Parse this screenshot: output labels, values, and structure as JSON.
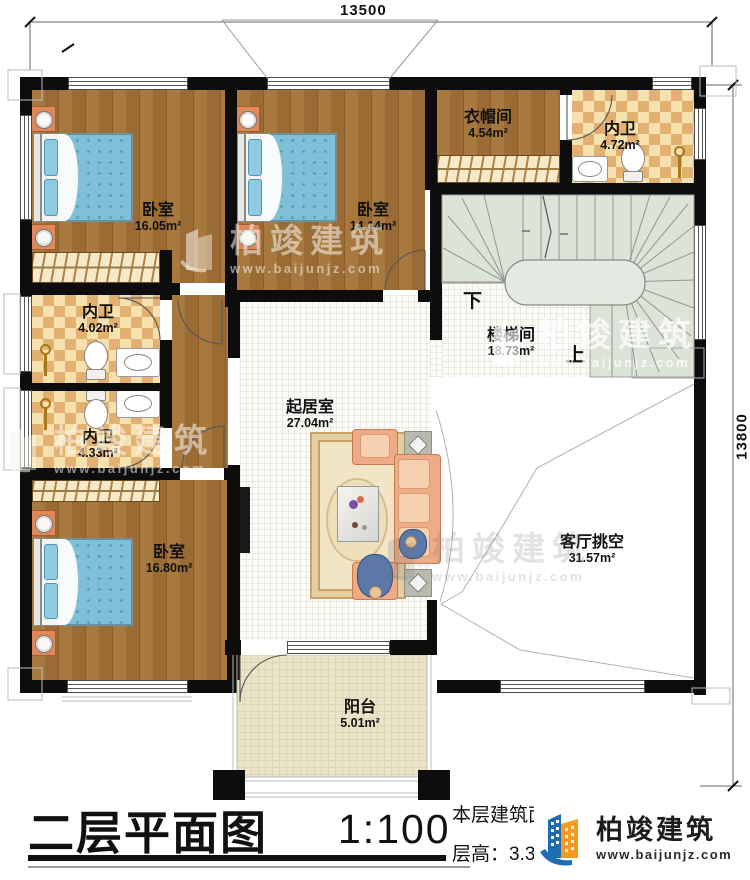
{
  "plan": {
    "dims": {
      "width": "13500",
      "height": "13800"
    },
    "stair_marks": {
      "down": "下",
      "up": "上"
    },
    "rooms": {
      "bedroom1": {
        "name": "卧室",
        "area": "16.05m²"
      },
      "bedroom2": {
        "name": "卧室",
        "area": "14.14m²"
      },
      "cloakroom": {
        "name": "衣帽间",
        "area": "4.54m²"
      },
      "bath_top": {
        "name": "内卫",
        "area": "4.72m²"
      },
      "bath_mid": {
        "name": "内卫",
        "area": "4.02m²"
      },
      "bath_low": {
        "name": "内卫",
        "area": "4.33m²"
      },
      "bedroom3": {
        "name": "卧室",
        "area": "16.80m²"
      },
      "living": {
        "name": "起居室",
        "area": "27.04m²"
      },
      "stairwell": {
        "name": "楼梯间",
        "area": "18.73m²"
      },
      "void": {
        "name": "客厅挑空",
        "area": "31.57m²"
      },
      "balcony": {
        "name": "阳台",
        "area": "5.01m²"
      }
    }
  },
  "titleblock": {
    "title": "二层平面图",
    "scale": "1:100",
    "area_label": "本层建筑面积：",
    "floor_height": "层高：3.3m"
  },
  "brand": {
    "name": "柏竣建筑",
    "url": "www.baijunjz.com"
  },
  "colors": {
    "logo_blue": "#1f6cb4",
    "logo_orange": "#f6991e",
    "wall": "#0d0d0d"
  }
}
